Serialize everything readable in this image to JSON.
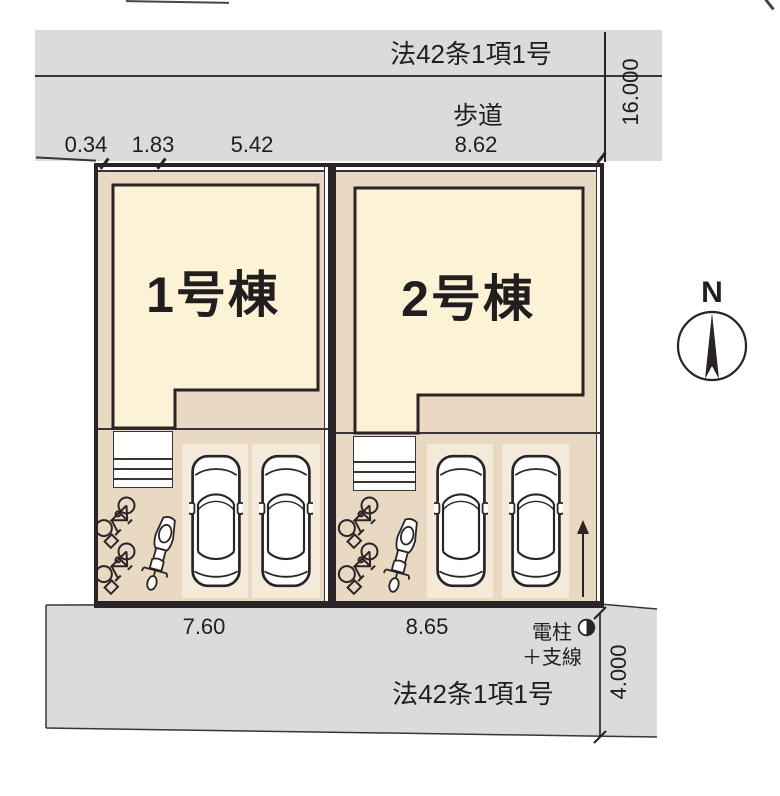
{
  "title": "区画図",
  "colors": {
    "road_fill": "#dbdbdc",
    "ground_fill": "#e9d9c3",
    "building_fill": "#fcf3d6",
    "parking_pad_fill": "#f3ead9",
    "outline": "#2b2426"
  },
  "roads": {
    "top": {
      "law": "法42条1項1号",
      "sidewalk": "歩道",
      "width_dim": "16.000",
      "dims": [
        "0.34",
        "1.83",
        "5.42",
        "8.62"
      ]
    },
    "bottom": {
      "law": "法42条1項1号",
      "width_dim": "4.000",
      "frontage_lot1": "7.60",
      "frontage_lot2": "8.65",
      "pole": "電柱",
      "pole_sub": "＋支線"
    }
  },
  "lots": [
    {
      "label": "1号棟"
    },
    {
      "label": "2号棟"
    }
  ],
  "compass": {
    "north": "N"
  }
}
